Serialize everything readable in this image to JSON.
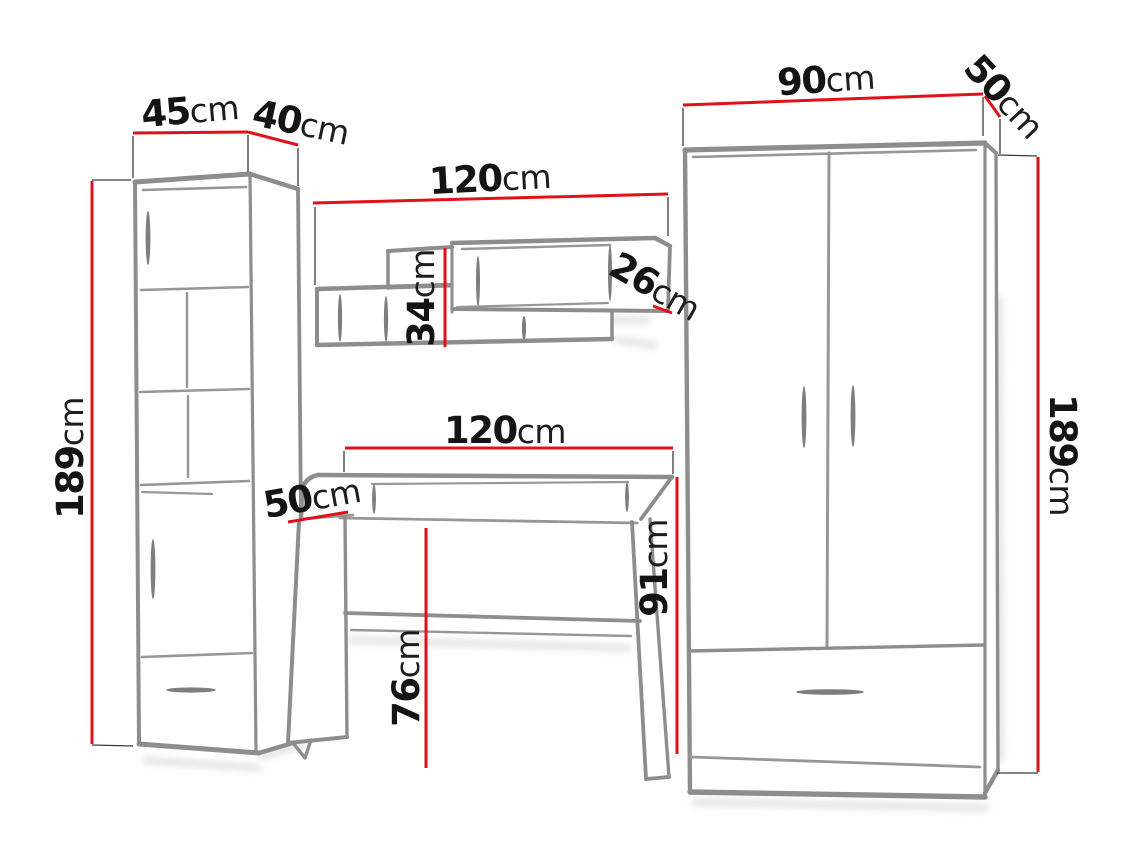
{
  "diagram": {
    "type": "furniture-dimension-sketch",
    "unit": "cm",
    "colors": {
      "dimension_line": "#e1111b",
      "sketch_stroke": "#8d8d8d",
      "extension_line": "#3a3a3a",
      "label_text": "#141414",
      "background": "#ffffff"
    },
    "pieces": {
      "bookcase": {
        "width": {
          "value": "45",
          "unit": "cm"
        },
        "depth": {
          "value": "40",
          "unit": "cm"
        },
        "height": {
          "value": "189",
          "unit": "cm"
        }
      },
      "wall_shelf": {
        "width": {
          "value": "120",
          "unit": "cm"
        },
        "height": {
          "value": "34",
          "unit": "cm"
        },
        "depth": {
          "value": "26",
          "unit": "cm"
        }
      },
      "desk": {
        "width": {
          "value": "120",
          "unit": "cm"
        },
        "depth": {
          "value": "50",
          "unit": "cm"
        },
        "height": {
          "value": "76",
          "unit": "cm"
        },
        "back_height": {
          "value": "91",
          "unit": "cm"
        }
      },
      "wardrobe": {
        "width": {
          "value": "90",
          "unit": "cm"
        },
        "depth": {
          "value": "50",
          "unit": "cm"
        },
        "height": {
          "value": "189",
          "unit": "cm"
        }
      }
    }
  }
}
